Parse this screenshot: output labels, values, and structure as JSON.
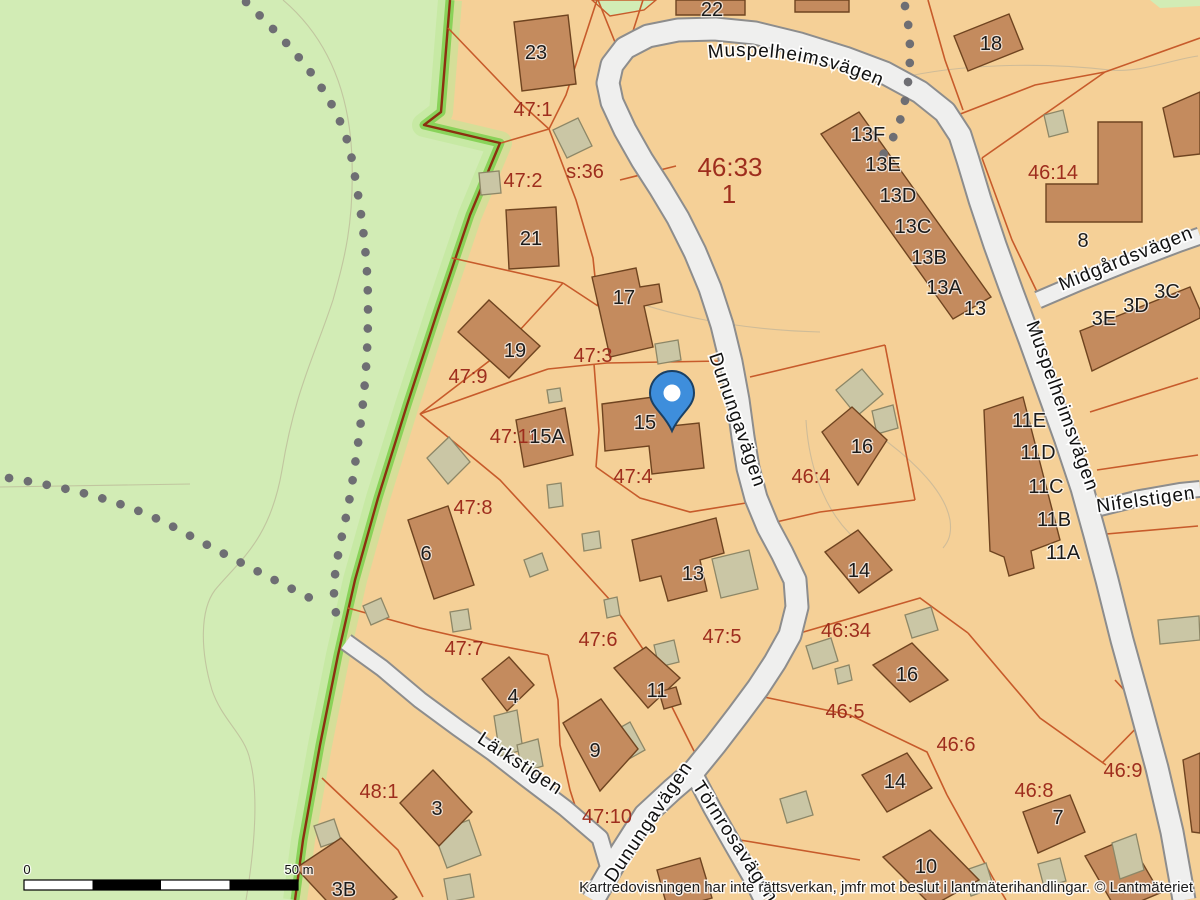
{
  "map": {
    "attribution": "Kartredovisningen har inte rättsverkan, jmfr mot beslut i lantmäterihandlingar. © Lantmäteriet",
    "scale_bar": {
      "start_label": "0",
      "end_label": "50 m"
    },
    "marker_icon": "location-pin",
    "colors": {
      "land-green": "#d2ecb5",
      "land-orange": "#f5d097",
      "road-fill": "#efefee",
      "road-casing": "#8d8d8d",
      "parcel-line": "#c75b2b",
      "building-fill": "#c48b5e",
      "building-stroke": "#6f4420",
      "outbuilding-fill": "#cac6a5",
      "outbuilding-stroke": "#8d8767",
      "boundary-band": "#82d052",
      "boundary-line": "#8b3010",
      "parcel-label": "#9e2d1d",
      "building-label": "#1b1b1b",
      "street-label": "#101010",
      "trail-dot": "#6e6e73",
      "pin-blue": "#3e8edc"
    },
    "streets": {
      "muspelheimsvagen_top": "Muspelheimsvägen",
      "muspelheimsvagen_right": "Muspelheimsvägen",
      "midgardsvagen": "Midgårdsvägen",
      "nifelstigen": "Nifelstigen",
      "dunungavagen_mid": "Dunungavägen",
      "dunungavagen_south": "Dunungavägen",
      "tornrosavagen": "Törnrosavägen",
      "larkstigen": "Lärkstigen"
    },
    "parcel_labels": [
      "47:1",
      "47:2",
      "s:36",
      "46:33",
      "1",
      "46:14",
      "47:3",
      "47:9",
      "47:11",
      "47:4",
      "46:4",
      "47:8",
      "47:6",
      "47:5",
      "46:34",
      "47:7",
      "46:5",
      "46:6",
      "48:1",
      "47:10",
      "46:8",
      "46:9"
    ],
    "building_labels": [
      "22",
      "23",
      "18",
      "13F",
      "13E",
      "13D",
      "13C",
      "13B",
      "13A",
      "13",
      "8",
      "3E",
      "3D",
      "3C",
      "21",
      "17",
      "19",
      "15A",
      "15",
      "16",
      "11E",
      "11D",
      "11C",
      "11B",
      "11A",
      "6",
      "13",
      "14",
      "11",
      "16",
      "4",
      "9",
      "14",
      "3",
      "7",
      "3B",
      "10"
    ]
  }
}
